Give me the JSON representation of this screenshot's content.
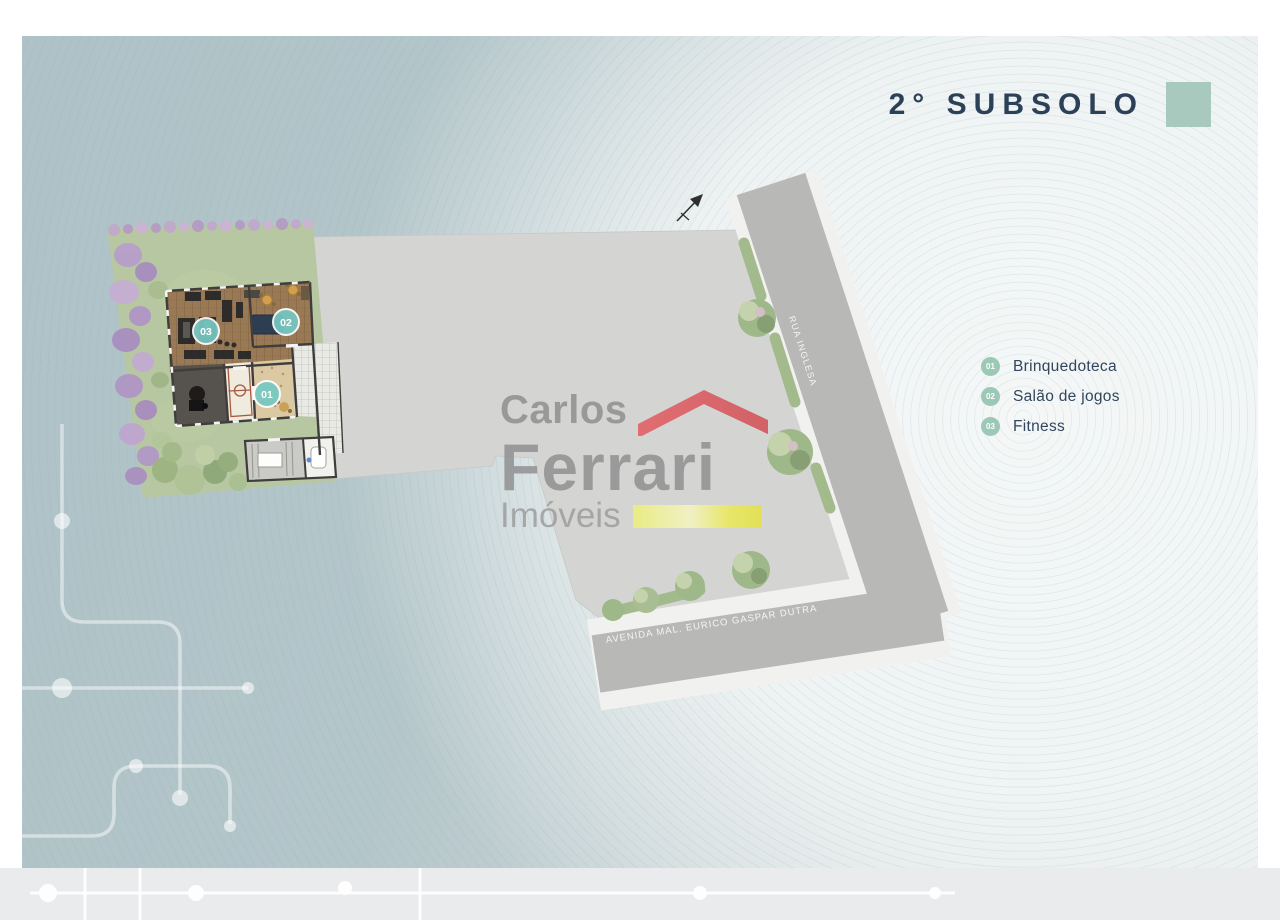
{
  "header": {
    "title": "2° SUBSOLO"
  },
  "legend": {
    "items": [
      {
        "number": "01",
        "label": "Brinquedoteca"
      },
      {
        "number": "02",
        "label": "Salão de jogos"
      },
      {
        "number": "03",
        "label": "Fitness"
      }
    ]
  },
  "watermark": {
    "top": "Carlos",
    "main": "Ferrari",
    "sub": "Imóveis"
  },
  "plan": {
    "markers": [
      {
        "number": "01"
      },
      {
        "number": "02"
      },
      {
        "number": "03"
      }
    ],
    "roads": [
      {
        "name": "RUA INGLESA"
      },
      {
        "name": "AVENIDA MAL. EURICO GASPAR DUTRA"
      }
    ]
  },
  "colors": {
    "panel_teal": "#b2c4c9",
    "slab_gray": "#d4d5d3",
    "road_gray": "#b8b9b6",
    "sidewalk_white": "#f1f2f0",
    "garden_green": "#b6c7a1",
    "wood_floor": "#9a7a55",
    "accent_swatch": "#a7c9be",
    "legend_badge": "#9cc8b6",
    "marker_teal": "#76c8c2",
    "title_text": "#2c4157",
    "roof_red": "#e0545a",
    "underline_yellow": "#ece74d"
  }
}
